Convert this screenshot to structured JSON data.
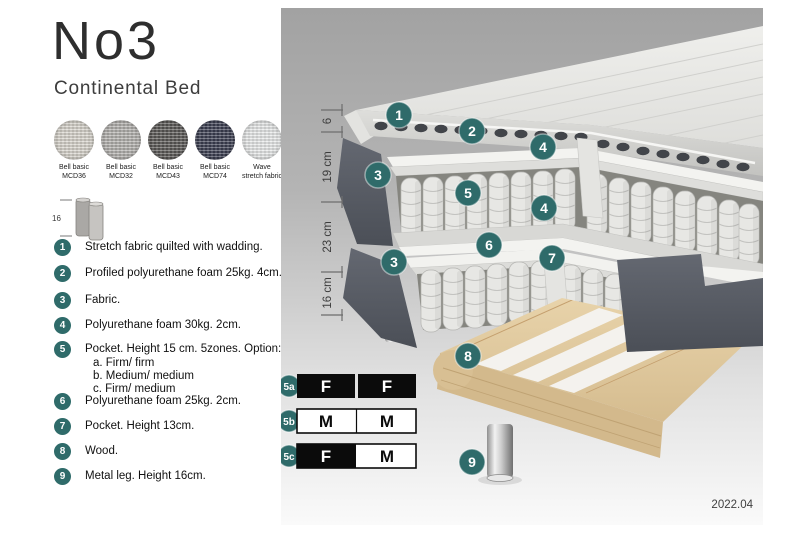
{
  "header": {
    "title": "No3",
    "subtitle": "Continental Bed"
  },
  "swatches": [
    {
      "line1": "Bell basic",
      "line2": "MCD36",
      "color": "#d9d5cd"
    },
    {
      "line1": "Bell basic",
      "line2": "MCD32",
      "color": "#b4b2af"
    },
    {
      "line1": "Bell basic",
      "line2": "MCD43",
      "color": "#5b5957"
    },
    {
      "line1": "Bell basic",
      "line2": "MCD74",
      "color": "#3d4053"
    },
    {
      "line1": "Wave",
      "line2": "stretch fabric",
      "color": "#e9ebeb"
    }
  ],
  "leg_thumbnail": {
    "height_label": "16"
  },
  "spec_list": [
    {
      "num": "1",
      "text": "Stretch fabric quilted with wadding."
    },
    {
      "num": "2",
      "text": "Profiled polyurethane foam 25kg. 4cm."
    },
    {
      "num": "3",
      "text": "Fabric."
    },
    {
      "num": "4",
      "text": "Polyurethane foam 30kg. 2cm."
    },
    {
      "num": "5",
      "text": "Pocket. Height 15 cm. 5zones. Option:",
      "options": [
        "a. Firm/ firm",
        "b. Medium/ medium",
        "c. Firm/ medium"
      ]
    },
    {
      "num": "6",
      "text": "Polyurethane foam 25kg. 2cm."
    },
    {
      "num": "7",
      "text": "Pocket. Height 13cm."
    },
    {
      "num": "8",
      "text": "Wood."
    },
    {
      "num": "9",
      "text": "Metal leg. Height 16cm."
    }
  ],
  "diagram": {
    "callouts": [
      "1",
      "2",
      "4",
      "3",
      "5",
      "4",
      "6",
      "7",
      "3",
      "8",
      "9"
    ],
    "ruler": [
      "6",
      "19 cm",
      "23 cm",
      "16 cm"
    ],
    "firmness": [
      {
        "id": "5a",
        "cells": [
          {
            "label": "F",
            "filled": true
          },
          {
            "label": "F",
            "filled": true
          }
        ]
      },
      {
        "id": "5b",
        "cells": [
          {
            "label": "M",
            "filled": false
          },
          {
            "label": "M",
            "filled": false
          }
        ]
      },
      {
        "id": "5c",
        "cells": [
          {
            "label": "F",
            "filled": true
          },
          {
            "label": "M",
            "filled": false
          }
        ]
      }
    ],
    "version": "2022.04"
  },
  "colors": {
    "accent_teal": "#2f6b6a",
    "fabric_dark": "#575c64",
    "wood": "#dfc89e",
    "panel_gray_top": "#a2a2a2",
    "panel_gray_bottom": "#f8f8f8"
  }
}
